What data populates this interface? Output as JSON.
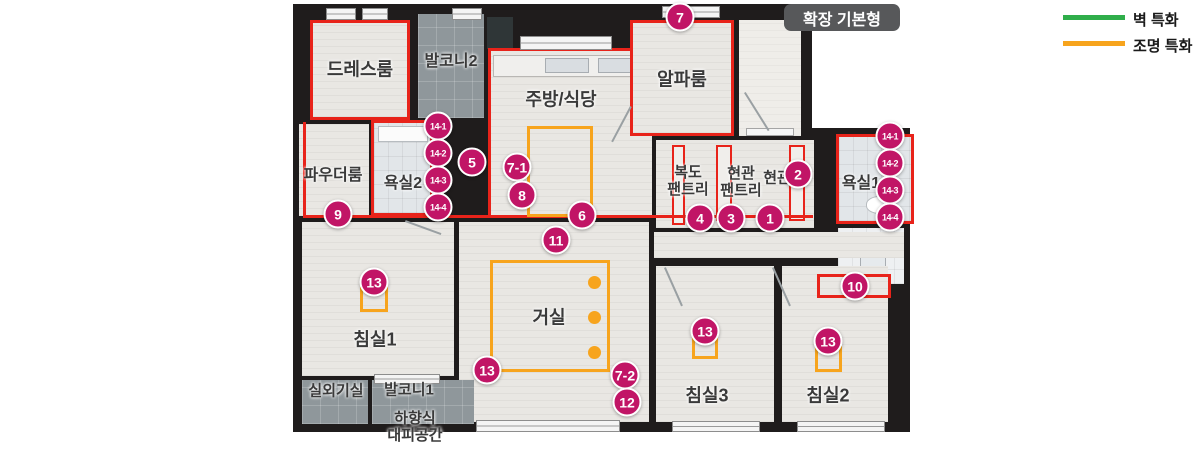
{
  "title_badge": "확장 기본형",
  "legend": {
    "wall": {
      "label": "벽 특화",
      "color": "#2fae4a"
    },
    "light": {
      "label": "조명 특화",
      "color": "#f7a41d"
    }
  },
  "rooms": {
    "dressroom": "드레스룸",
    "balcony2": "발코니2",
    "kitchen": "주방/식당",
    "alpha": "알파룸",
    "powder": "파우더룸",
    "bath2": "욕실2",
    "corridor_pantry": "복도\n팬트리",
    "entrance_pantry": "현관\n팬트리",
    "entrance": "현관",
    "bath1": "욕실1",
    "bed1": "침실1",
    "living": "거실",
    "bed3": "침실3",
    "bed2": "침실2",
    "outdoor_unit": "실외기실",
    "balcony1": "발코니1",
    "evac": "하향식\n대피공간"
  },
  "markers": [
    {
      "num": "1",
      "x": 770,
      "y": 218
    },
    {
      "num": "2",
      "x": 798,
      "y": 174
    },
    {
      "num": "3",
      "x": 731,
      "y": 218
    },
    {
      "num": "4",
      "x": 700,
      "y": 218
    },
    {
      "num": "5",
      "x": 472,
      "y": 162
    },
    {
      "num": "6",
      "x": 582,
      "y": 215
    },
    {
      "num": "7",
      "x": 680,
      "y": 17
    },
    {
      "num": "7-1",
      "x": 517,
      "y": 167
    },
    {
      "num": "7-2",
      "x": 625,
      "y": 375
    },
    {
      "num": "8",
      "x": 522,
      "y": 195
    },
    {
      "num": "9",
      "x": 338,
      "y": 214
    },
    {
      "num": "10",
      "x": 855,
      "y": 286
    },
    {
      "num": "11",
      "x": 556,
      "y": 240
    },
    {
      "num": "12",
      "x": 627,
      "y": 402
    },
    {
      "num": "13",
      "x": 374,
      "y": 282
    },
    {
      "num": "13",
      "x": 487,
      "y": 370
    },
    {
      "num": "13",
      "x": 705,
      "y": 331
    },
    {
      "num": "13",
      "x": 828,
      "y": 341
    },
    {
      "num": "14-1",
      "x": 438,
      "y": 126,
      "small": true
    },
    {
      "num": "14-2",
      "x": 438,
      "y": 153,
      "small": true
    },
    {
      "num": "14-3",
      "x": 438,
      "y": 180,
      "small": true
    },
    {
      "num": "14-4",
      "x": 438,
      "y": 207,
      "small": true
    },
    {
      "num": "14-1",
      "x": 890,
      "y": 136,
      "small": true
    },
    {
      "num": "14-2",
      "x": 890,
      "y": 163,
      "small": true
    },
    {
      "num": "14-3",
      "x": 890,
      "y": 190,
      "small": true
    },
    {
      "num": "14-4",
      "x": 890,
      "y": 217,
      "small": true
    }
  ],
  "colors": {
    "marker": "#c11566",
    "red_accent": "#e8231a",
    "lighting_orange": "#f7a41d",
    "wall_green": "#2fae4a",
    "wall_dark": "#1f1c1c"
  }
}
